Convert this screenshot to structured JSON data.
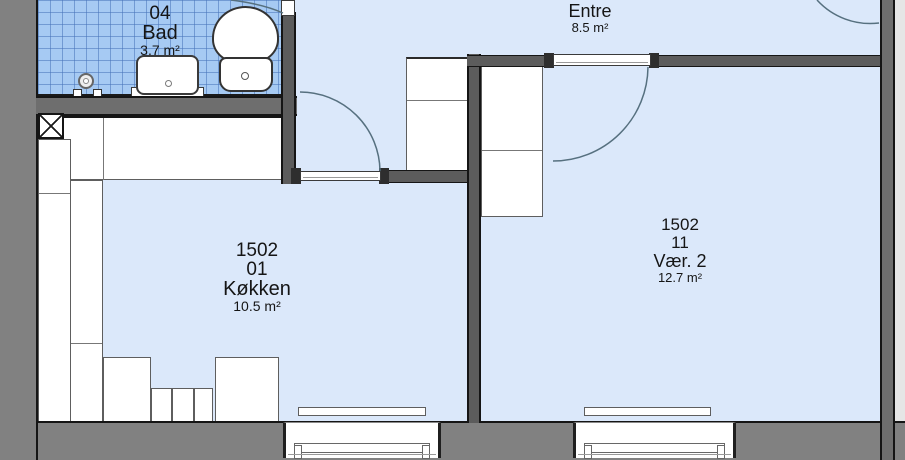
{
  "floorplan": {
    "rooms": {
      "bad": {
        "number": "1502",
        "unit": "04",
        "name": "Bad",
        "area": "3.7 m²"
      },
      "entre": {
        "name": "Entre",
        "area": "8.5 m²"
      },
      "kokken": {
        "number": "1502",
        "unit": "01",
        "name": "Køkken",
        "area": "10.5 m²"
      },
      "vaer2": {
        "number": "1502",
        "unit": "11",
        "name": "Vær. 2",
        "area": "12.7 m²"
      }
    },
    "colors": {
      "floor": "#dbe8fa",
      "bathroom_tile": "#a6caf3",
      "tile_grid_line": "#4673b9",
      "outer_wall": "#818181",
      "inner_wall": "#5c5c5c",
      "outline": "#151515",
      "fixture_fill": "#ffffff",
      "door_arc": "#56707f"
    },
    "elements": {
      "doors": [
        "bathroom-door",
        "kitchen-door",
        "vaer2-door",
        "upper-right-door"
      ],
      "windows": [
        "kitchen-window",
        "vaer2-window"
      ],
      "radiators": 2,
      "fixtures": [
        "toilet",
        "sink",
        "shower-valve",
        "ventilation-shaft",
        "kitchen-counters",
        "entre-wardrobe",
        "vaer2-wardrobe"
      ]
    }
  }
}
